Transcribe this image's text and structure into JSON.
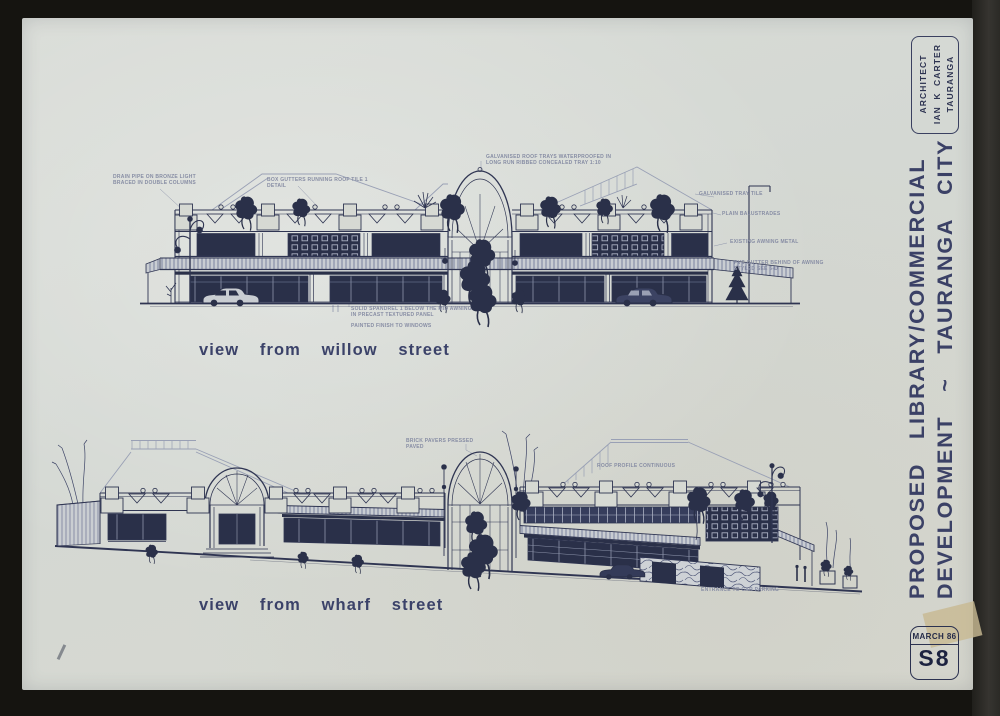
{
  "palette": {
    "frame": "#151410",
    "paper": "#d6d9d3",
    "ink": "#2f3552",
    "ink_dark": "#2a3049",
    "faint_line": "#99a0b5",
    "annotation": "#878da4",
    "tape": "#c8ba92"
  },
  "sheet": {
    "architect_box": {
      "line1": "ARCHITECT",
      "line2": "IAN K CARTER",
      "line3": "TAURANGA"
    },
    "title_line1": "PROPOSED LIBRARY/COMMERCIAL",
    "title_line2": "DEVELOPMENT ~ TAURANGA CITY",
    "date": "MARCH 86",
    "number": "S8"
  },
  "labels": {
    "upper_view": "view from willow street",
    "lower_view": "view from wharf street"
  },
  "annotations": {
    "upper": {
      "a1": "DRAIN PIPE ON BRONZE LIGHT\nBRACED IN DOUBLE COLUMNS",
      "a2": "BOX GUTTERS RUNNING ROOF TILE 1\nDETAIL",
      "a3": "GALVANISED ROOF TRAYS WATERPROOFED IN\nLONG RUN RIBBED CONCEALED TRAY 1:10",
      "a4": "GALVANISED TRAY TILE",
      "a5": "PLAIN BALUSTRADES",
      "a6": "EXISTING AWNING METAL",
      "a7": "PVC GUTTER BEHIND OF AWNING\nSTYLED SEE 5-D",
      "a8": "SOLID SPANDREL 1 BELOW THE MID AWNING\nIN PRECAST TEXTURED PANEL",
      "a9": "PAINTED FINISH TO WINDOWS"
    },
    "lower": {
      "b1": "BRICK PAVERS PRESSED\nPAVED",
      "b2": "ROOF PROFILE CONTINUOUS",
      "b3": "ENTRANCE TO CAR PARKING"
    }
  }
}
